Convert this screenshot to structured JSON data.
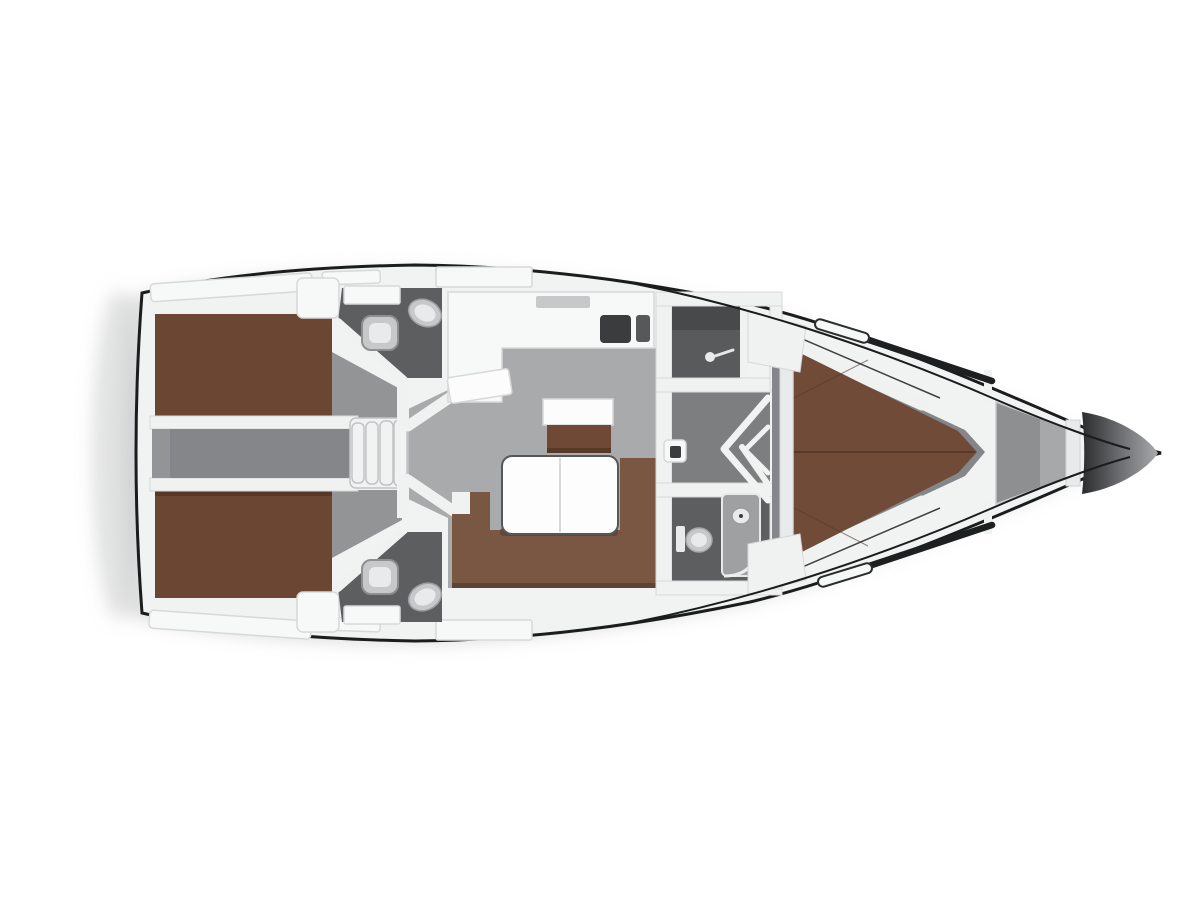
{
  "meta": {
    "alt": "Top-down interior floor plan of a sailing yacht, bow pointing right"
  },
  "legend": {
    "regions": [
      "transom",
      "aft-cabin-port",
      "aft-cabin-starboard",
      "aft-head-port",
      "aft-head-starboard",
      "engine-compartment",
      "companionway-steps",
      "galley",
      "salon",
      "navigation-cabinet",
      "saloon-table",
      "u-sofa",
      "shower-room",
      "forward-corridor",
      "forward-head",
      "forward-cabin",
      "island-bed",
      "anchor-locker",
      "bow-tip"
    ],
    "fixtures": [
      "sink",
      "toilet",
      "stove",
      "shower-handle",
      "shower-unit",
      "door-chevron",
      "deck-locker"
    ]
  },
  "colors": {
    "background": "#ffffff",
    "shadow": "#c6c7c8",
    "hull_fill": "#f1f2f2",
    "hull_line": "#1b1c1d",
    "deck_fitting": "#f7f8f8",
    "deck_stroke": "#d7d8d9",
    "divider_white": "#f0f1f1",
    "mattress": "#6b4733",
    "mattress_shadow": "#583927",
    "bed_fwd": "#6f4b38",
    "bed_seam": "#55392a",
    "sofa": "#7a5743",
    "sofa_shadow": "#5e4434",
    "cabinet_top": "#fcfcfd",
    "cabinet_base": "#6f4936",
    "table_white": "#fdfdfe",
    "table_edge": "#555758",
    "salon_floor": "#a9aaac",
    "cabin_floor": "#939496",
    "engine_floor": "#85868a",
    "corridor_floor": "#7d7e80",
    "head_floor": "#5d5e60",
    "shower_floor": "#595a5c",
    "shower_dark": "#48494b",
    "sink_dark": "#3b3c3e",
    "fixture_light": "#e9eaeb",
    "fixture_mid": "#c7c8ca",
    "locker_gray": "#8e8f91",
    "locker_light": "#a7a8aa",
    "steps_fill": "#f1f2f2",
    "steps_line": "#c2c3c4",
    "bow_dark": "#2b2c2d",
    "bow_mid": "#66676a",
    "bow_light": "#a8a9ab"
  }
}
